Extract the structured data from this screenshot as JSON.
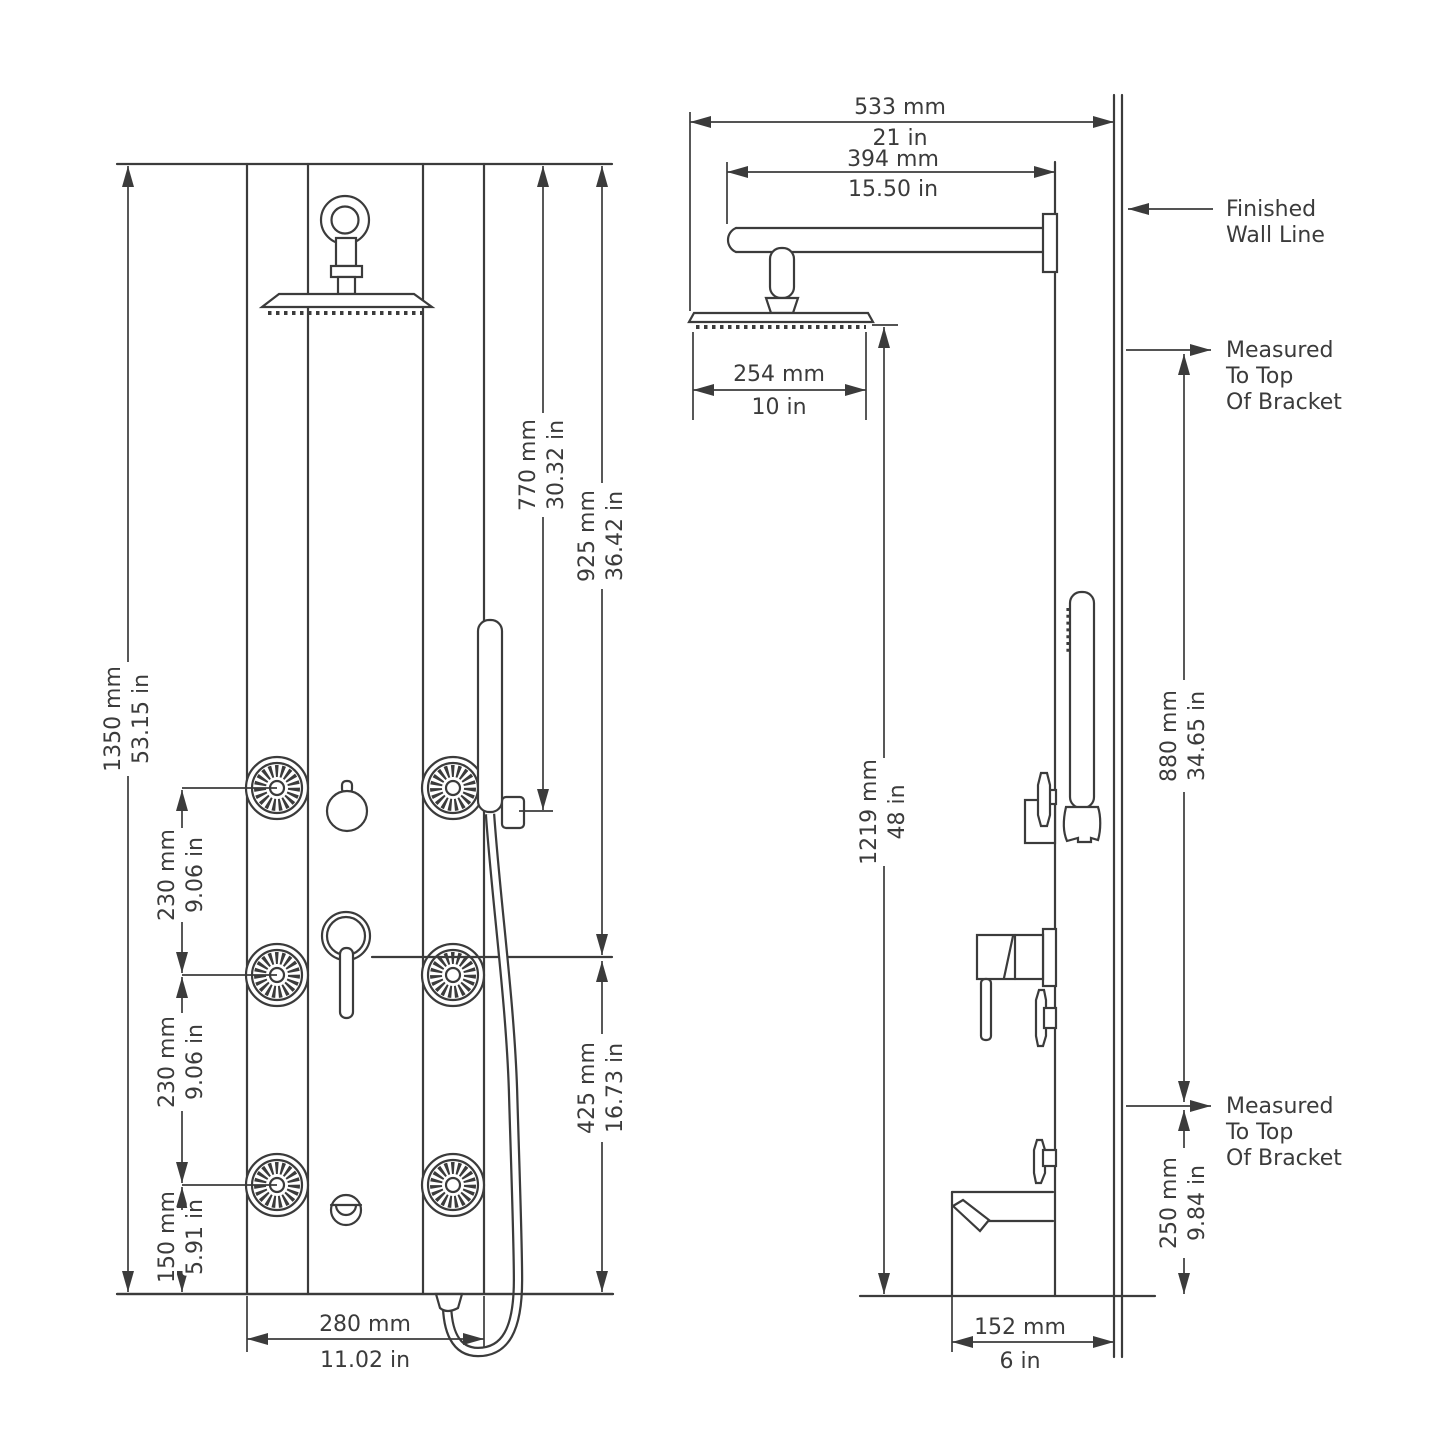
{
  "diagram": {
    "kind": "shower-panel-installation-dimensions",
    "views": [
      "front",
      "side"
    ],
    "line_color": "#3b3b3b",
    "background_color": "#ffffff"
  },
  "front_view": {
    "overall_height": {
      "mm": "1350 mm",
      "in": "53.15 in"
    },
    "top_to_holder": {
      "mm": "770 mm",
      "in": "30.32 in"
    },
    "top_to_mixer": {
      "mm": "925 mm",
      "in": "36.42 in"
    },
    "mixer_to_floor": {
      "mm": "425 mm",
      "in": "16.73 in"
    },
    "jet_spacing_upper": {
      "mm": "230 mm",
      "in": "9.06 in"
    },
    "jet_spacing_lower": {
      "mm": "230 mm",
      "in": "9.06 in"
    },
    "jet_to_floor": {
      "mm": "150 mm",
      "in": "5.91 in"
    },
    "panel_width": {
      "mm": "280 mm",
      "in": "11.02 in"
    }
  },
  "side_view": {
    "head_to_wall": {
      "mm": "533 mm",
      "in": "21 in"
    },
    "arm_length": {
      "mm": "394 mm",
      "in": "15.50 in"
    },
    "head_width": {
      "mm": "254 mm",
      "in": "10 in"
    },
    "head_to_floor": {
      "mm": "1219 mm",
      "in": "48 in"
    },
    "bracket_spacing": {
      "mm": "880 mm",
      "in": "34.65 in"
    },
    "lower_bracket_to_floor": {
      "mm": "250 mm",
      "in": "9.84 in"
    },
    "spout_to_wall": {
      "mm": "152 mm",
      "in": "6 in"
    },
    "wall_note": {
      "line1": "Finished",
      "line2": "Wall Line"
    },
    "bracket_note_top": {
      "line1": "Measured",
      "line2": "To Top",
      "line3": "Of Bracket"
    },
    "bracket_note_bottom": {
      "line1": "Measured",
      "line2": "To Top",
      "line3": "Of Bracket"
    }
  }
}
